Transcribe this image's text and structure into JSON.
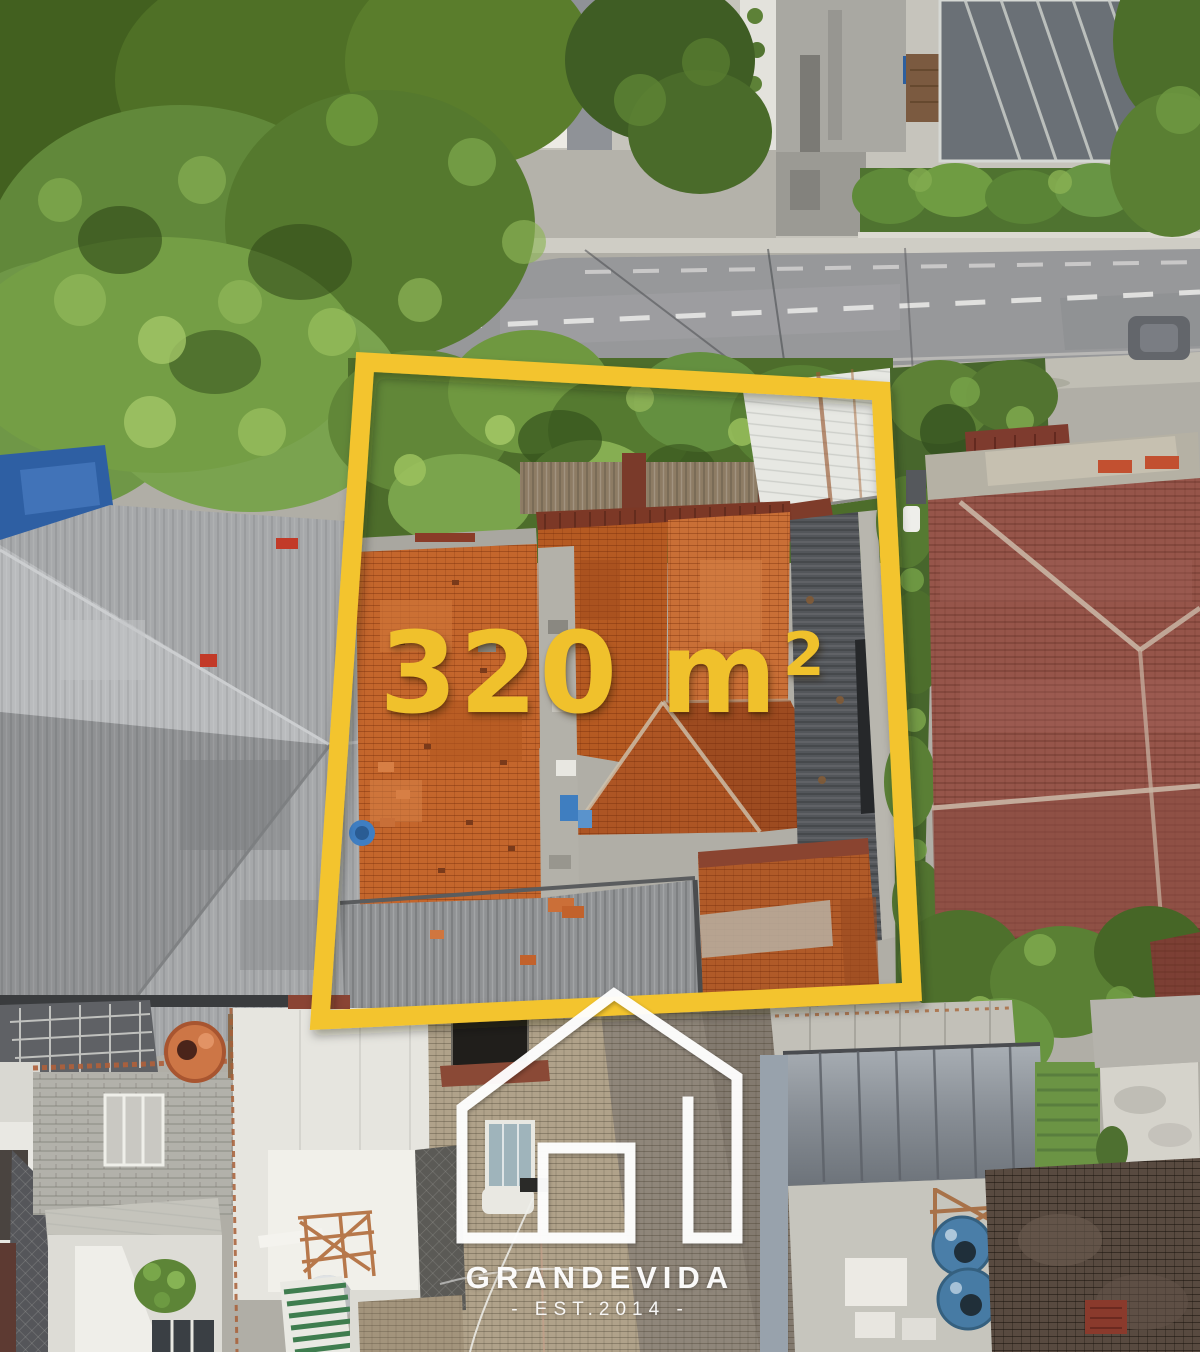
{
  "overlay": {
    "area_label": {
      "full": "320 m²",
      "number": "320 m",
      "superscript": "2"
    },
    "brand": {
      "name": "GRANDEVIDA",
      "tagline": "- EST.2014 -"
    },
    "colors": {
      "accent_yellow": "#F3C42E",
      "logo_white": "#FFFFFF"
    }
  }
}
